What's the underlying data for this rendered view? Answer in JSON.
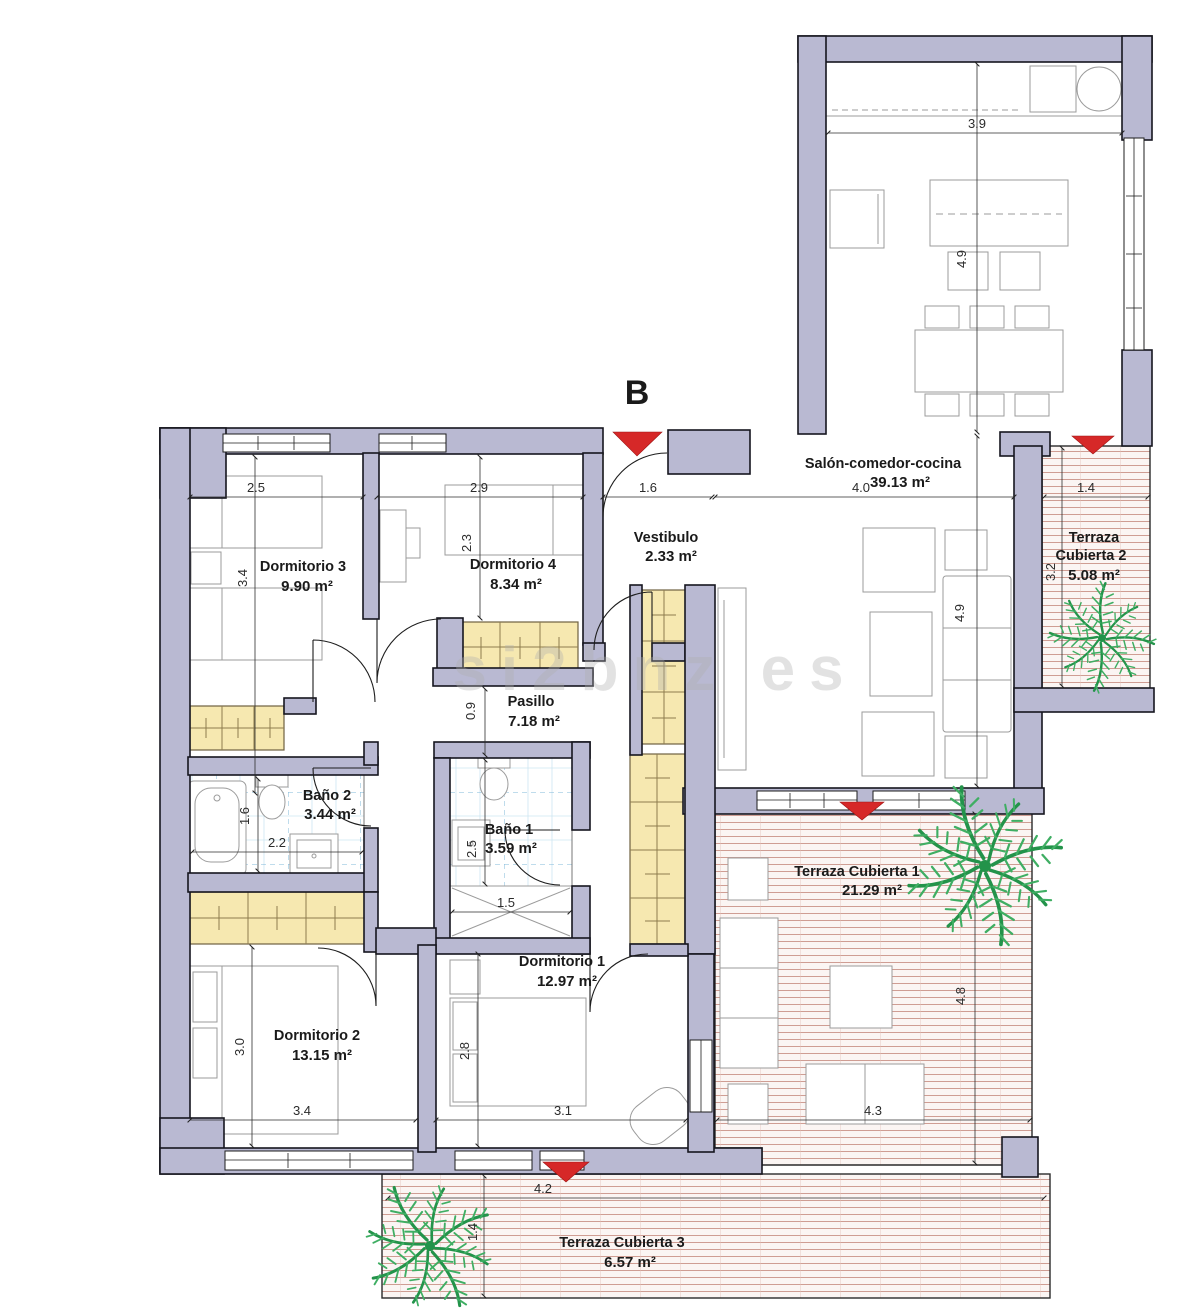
{
  "block_label": "B",
  "watermark": "si2bnz es",
  "rooms": {
    "salon": {
      "name": "Salón-comedor-cocina",
      "area": "39.13 m²"
    },
    "vestibulo": {
      "name": "Vestibulo",
      "area": "2.33 m²"
    },
    "dormitorio3": {
      "name": "Dormitorio 3",
      "area": "9.90 m²"
    },
    "dormitorio4": {
      "name": "Dormitorio 4",
      "area": "8.34 m²"
    },
    "pasillo": {
      "name": "Pasillo",
      "area": "7.18 m²"
    },
    "bano2": {
      "name": "Baño 2",
      "area": "3.44 m²"
    },
    "bano1": {
      "name": "Baño 1",
      "area": "3.59 m²"
    },
    "dormitorio1": {
      "name": "Dormitorio 1",
      "area": "12.97 m²"
    },
    "dormitorio2": {
      "name": "Dormitorio 2",
      "area": "13.15 m²"
    },
    "terraza1": {
      "name": "Terraza Cubierta 1",
      "area": "21.29 m²"
    },
    "terraza2": {
      "name_line1": "Terraza",
      "name_line2": "Cubierta 2",
      "area": "5.08 m²"
    },
    "terraza3": {
      "name": "Terraza Cubierta 3",
      "area": "6.57 m²"
    }
  },
  "dims": {
    "d3_w": "2.5",
    "d3_d": "3.4",
    "d4_w": "2.9",
    "d4_d": "2.3",
    "vest_w": "1.6",
    "salon_w": "4.0",
    "salon_d": "4.9",
    "kitchen_w": "3.9",
    "kitchen_d": "4.9",
    "pasillo_w": "0.9",
    "b2_w": "2.2",
    "b2_d": "1.6",
    "b1_w": "1.5",
    "b1_d": "2.5",
    "d2_w": "3.4",
    "d2_d": "3.0",
    "d1_w": "3.1",
    "d1_d": "2.8",
    "t1_w": "4.3",
    "t1_d": "4.8",
    "t2_w": "1.4",
    "t2_d": "3.2",
    "t3_w": "4.2",
    "t3_d": "1.4"
  },
  "colors": {
    "wall_fill": "#b9b9d2",
    "terrace_stripe": "#cf9d93",
    "tile_line": "#b9dcec",
    "wardrobe_fill": "#f6e8b0",
    "arrow_red": "#d62828",
    "palm_green": "#23934a"
  }
}
